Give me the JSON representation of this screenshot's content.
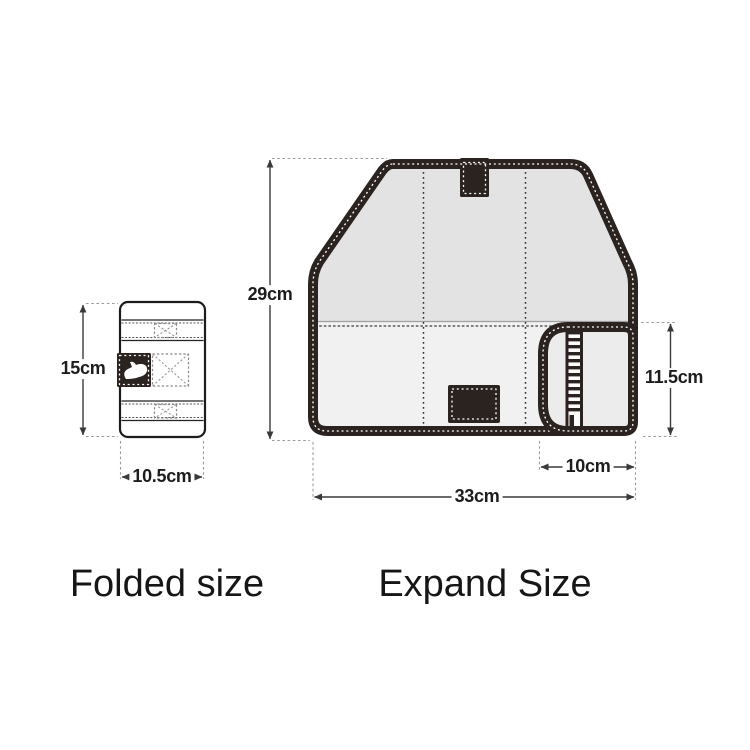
{
  "figure": {
    "folded": {
      "caption": "Folded size",
      "height_label": "15cm",
      "width_label": "10.5cm"
    },
    "expanded": {
      "caption": "Expand Size",
      "height_label": "29cm",
      "width_label": "33cm",
      "flap_height_label": "11.5cm",
      "flap_width_label": "10cm"
    },
    "icons": {
      "brand_logo": "paw-logo",
      "velcro_marks": "dashed-x-patch",
      "fastener_strip": "ladder-zipper-strip"
    },
    "colors": {
      "trim_dark": "#2b2320",
      "panel_top": "#e3e3e3",
      "panel_bottom": "#f1f1f1",
      "flap_fill": "#ececec",
      "dim_line": "#3a3a3a",
      "ext_line": "#9a9a9a",
      "text": "#1d1d1d"
    }
  }
}
